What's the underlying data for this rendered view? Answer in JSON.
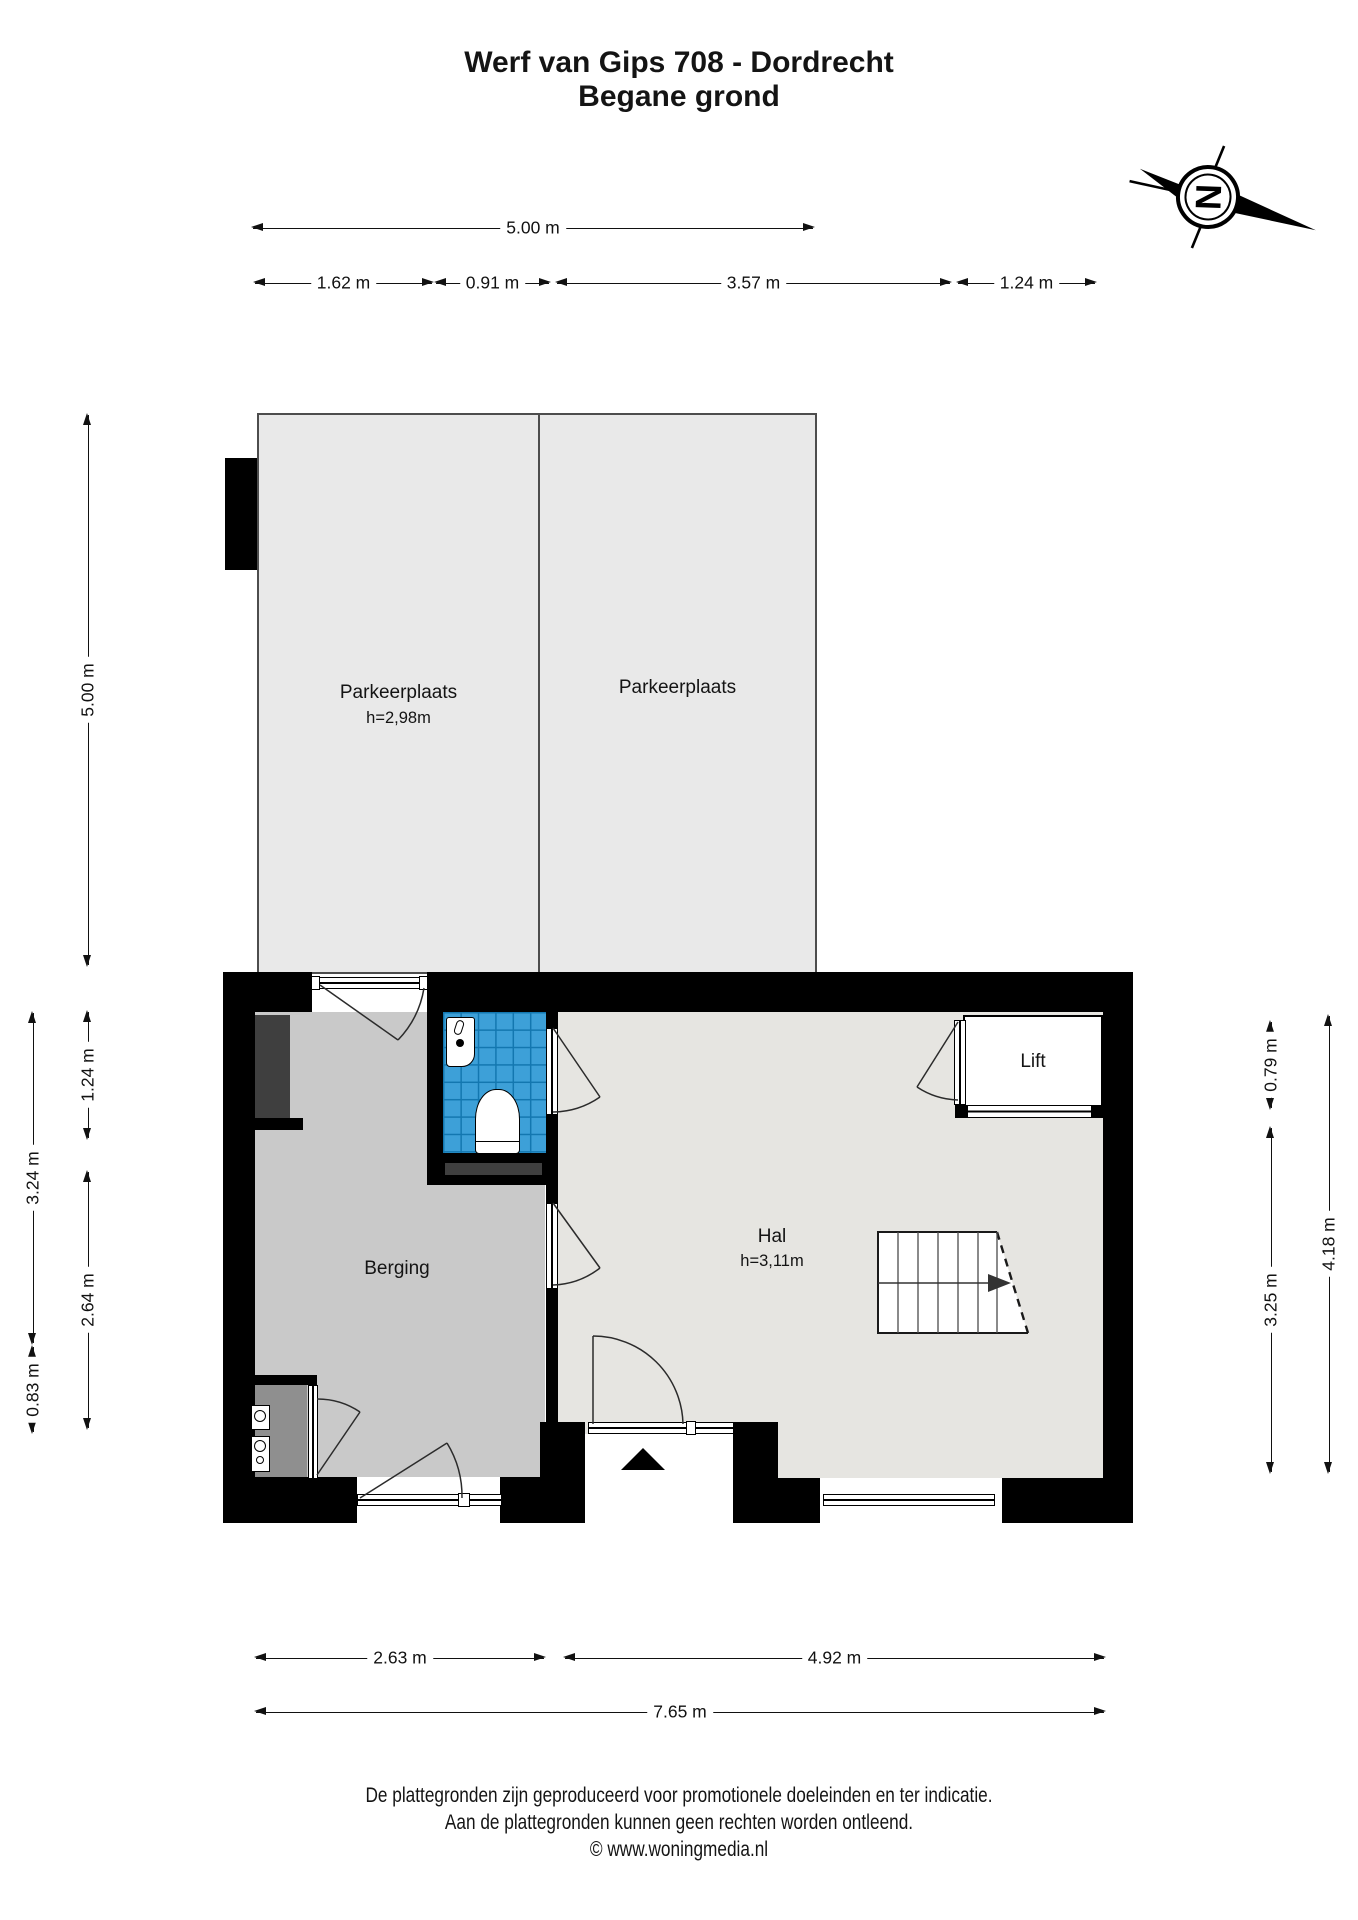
{
  "title": {
    "line1": "Werf van Gips 708 - Dordrecht",
    "line2": "Begane grond"
  },
  "compass": {
    "north_letter": "N"
  },
  "parking": {
    "left": {
      "label": "Parkeerplaats",
      "ceiling_height": "h=2,98m"
    },
    "right": {
      "label": "Parkeerplaats"
    }
  },
  "rooms": {
    "berging": {
      "label": "Berging"
    },
    "hal": {
      "label": "Hal",
      "ceiling_height": "h=3,11m"
    },
    "lift": {
      "label": "Lift"
    }
  },
  "dimensions": {
    "top": {
      "total": "5.00 m",
      "seg1": "1.62 m",
      "seg2": "0.91 m",
      "seg3": "3.57 m",
      "seg4": "1.24 m"
    },
    "left": {
      "parking_depth": "5.00 m",
      "outer": "3.24 m",
      "outer_small": "0.83 m",
      "inner_top": "1.24 m",
      "inner_bottom": "2.64 m"
    },
    "right": {
      "lift_depth": "0.79 m",
      "hal_depth": "3.25 m",
      "outer": "4.18 m"
    },
    "bottom": {
      "left": "2.63 m",
      "right": "4.92 m",
      "total": "7.65 m"
    }
  },
  "footer": {
    "line1": "De plattegronden zijn geproduceerd voor promotionele doeleinden en ter indicatie.",
    "line2": "Aan de plattegronden kunnen geen rechten worden ontleend.",
    "line3": "© www.woningmedia.nl"
  },
  "colors": {
    "wall": "#000000",
    "parking_floor": "#e9e9e9",
    "berging_floor": "#c9c9c9",
    "hal_floor": "#e6e5e1",
    "toilet_tile": "#3da0d8",
    "toilet_grout": "#1377b0",
    "fixture_dark": "#3f3f3f"
  }
}
